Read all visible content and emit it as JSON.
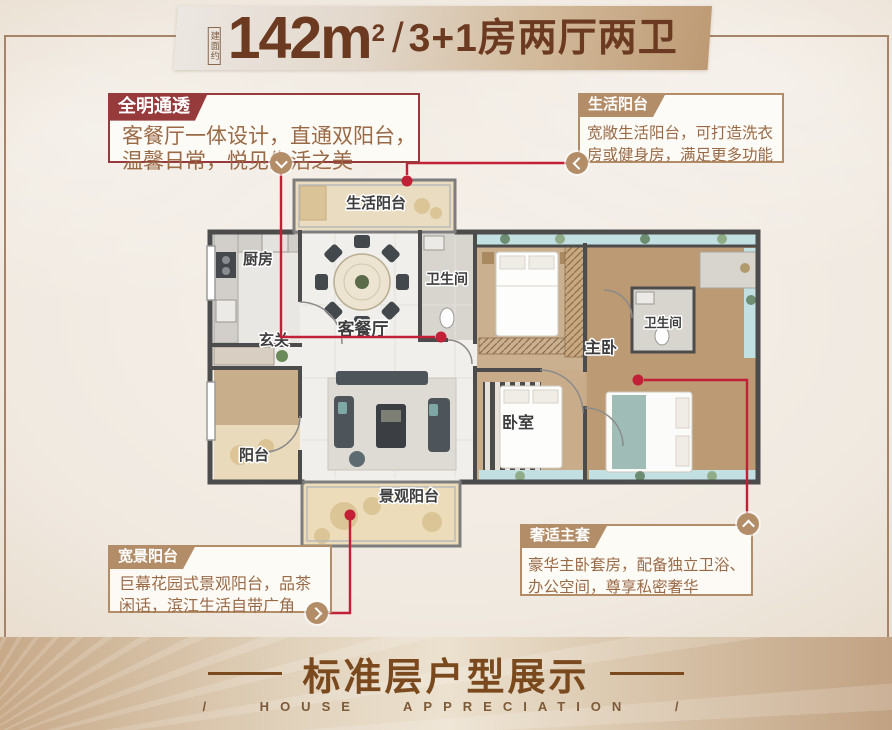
{
  "banner": {
    "area_label": "建面约",
    "area_value": "142",
    "unit": "m",
    "unit_sup": "2",
    "separator": "/",
    "layout_text": "3+1房两厅两卫"
  },
  "notes": [
    {
      "tag": "全明通透",
      "lines": [
        "客餐厅一体设计，直通双阳台，",
        "温馨日常，悦见生活之美"
      ]
    },
    {
      "tag": "生活阳台",
      "lines": [
        "宽敞生活阳台，可打造洗衣",
        "房或健身房，满足更多功能"
      ]
    },
    {
      "tag": "宽景阳台",
      "lines": [
        "巨幕花园式景观阳台，品茶",
        "闲话，滨江生活自带广角"
      ]
    },
    {
      "tag": "奢适主套",
      "lines": [
        "豪华主卧套房，配备独立卫浴、",
        "办公空间，尊享私密奢华"
      ]
    }
  ],
  "plan": {
    "rooms": {
      "service_balcony": "生活阳台",
      "kitchen": "厨房",
      "foyer": "玄关",
      "living_dining": "客餐厅",
      "bath1": "卫生间",
      "bath2": "卫生间",
      "master": "主卧",
      "bedroom": "卧室",
      "balcony": "阳台",
      "view_balcony": "景观阳台"
    }
  },
  "footer": {
    "title": "标准层户型展示",
    "subtitle": "/ HOUSE APPRECIATION /"
  },
  "colors": {
    "accent_red": "#c22036",
    "tag_tan": "#b28d68",
    "tag_dark_red": "#963a3c",
    "title_brown": "#6b3a20",
    "footer_brown": "#7a4a1e"
  }
}
